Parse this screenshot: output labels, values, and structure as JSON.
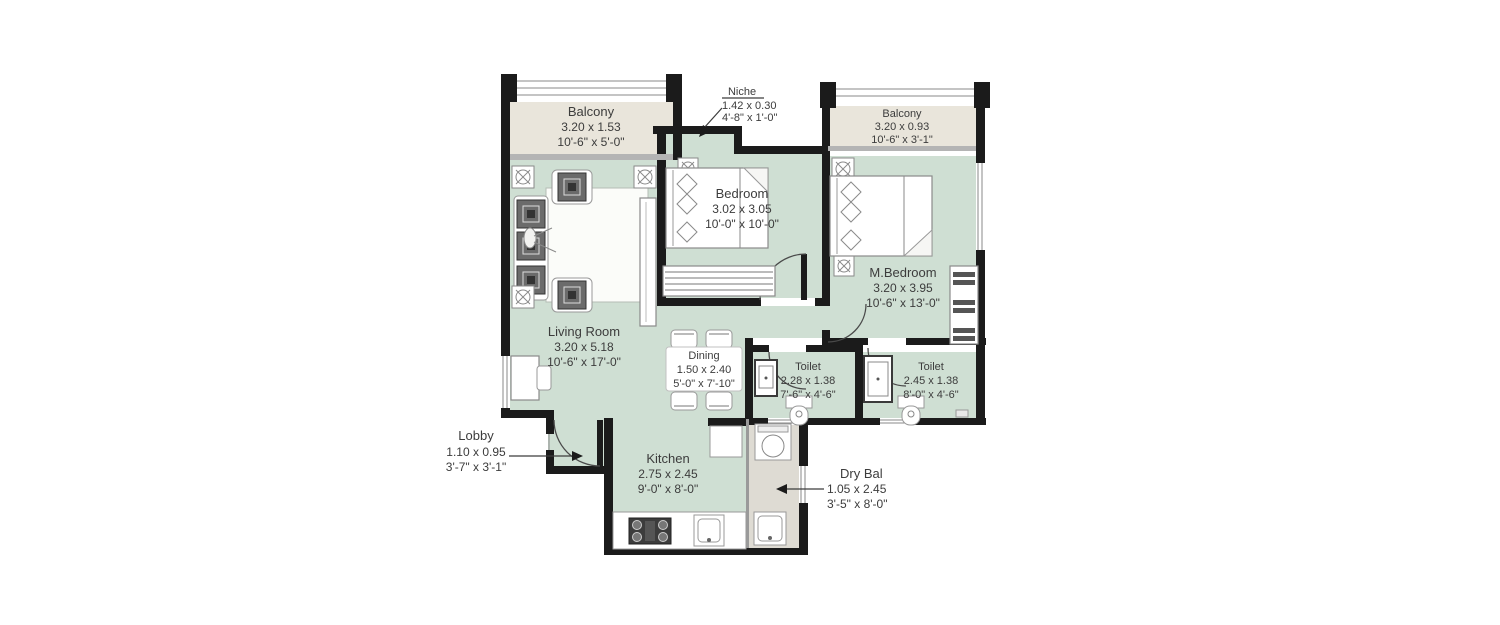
{
  "plan": {
    "title": "2BHK apartment floor plan",
    "rooms": {
      "balcony1": {
        "name": "Balcony",
        "m": "3.20 x 1.53",
        "ft": "10'-6\" x 5'-0\""
      },
      "balcony2": {
        "name": "Balcony",
        "m": "3.20 x 0.93",
        "ft": "10'-6\" x 3'-1\""
      },
      "niche": {
        "name": "Niche",
        "m": "1.42 x 0.30",
        "ft": "4'-8\" x 1'-0\""
      },
      "bedroom": {
        "name": "Bedroom",
        "m": "3.02 x 3.05",
        "ft": "10'-0\" x 10'-0\""
      },
      "master_bedroom": {
        "name": "M.Bedroom",
        "m": "3.20 x 3.95",
        "ft": "10'-6\" x 13'-0\""
      },
      "living": {
        "name": "Living Room",
        "m": "3.20 x 5.18",
        "ft": "10'-6\" x 17'-0\""
      },
      "dining": {
        "name": "Dining",
        "m": "1.50 x 2.40",
        "ft": "5'-0\" x 7'-10\""
      },
      "toilet1": {
        "name": "Toilet",
        "m": "2.28 x 1.38",
        "ft": "7'-6\" x 4'-6\""
      },
      "toilet2": {
        "name": "Toilet",
        "m": "2.45 x 1.38",
        "ft": "8'-0\" x 4'-6\""
      },
      "kitchen": {
        "name": "Kitchen",
        "m": "2.75 x 2.45",
        "ft": "9'-0\" x 8'-0\""
      },
      "lobby": {
        "name": "Lobby",
        "m": "1.10 x 0.95",
        "ft": "3'-7\" x 3'-1\""
      },
      "dry_balcony": {
        "name": "Dry Bal",
        "m": "1.05 x 2.45",
        "ft": "3'-5\" x 8'-0\""
      }
    },
    "colors": {
      "wall": "#1b1b1b",
      "room_fill": "#cfdfd3",
      "balcony_fill": "#e9e5db",
      "dry_balcony_fill": "#dedbd3",
      "sill": "#b4b4b4",
      "text": "#3c3c3c",
      "background": "#ffffff"
    }
  }
}
